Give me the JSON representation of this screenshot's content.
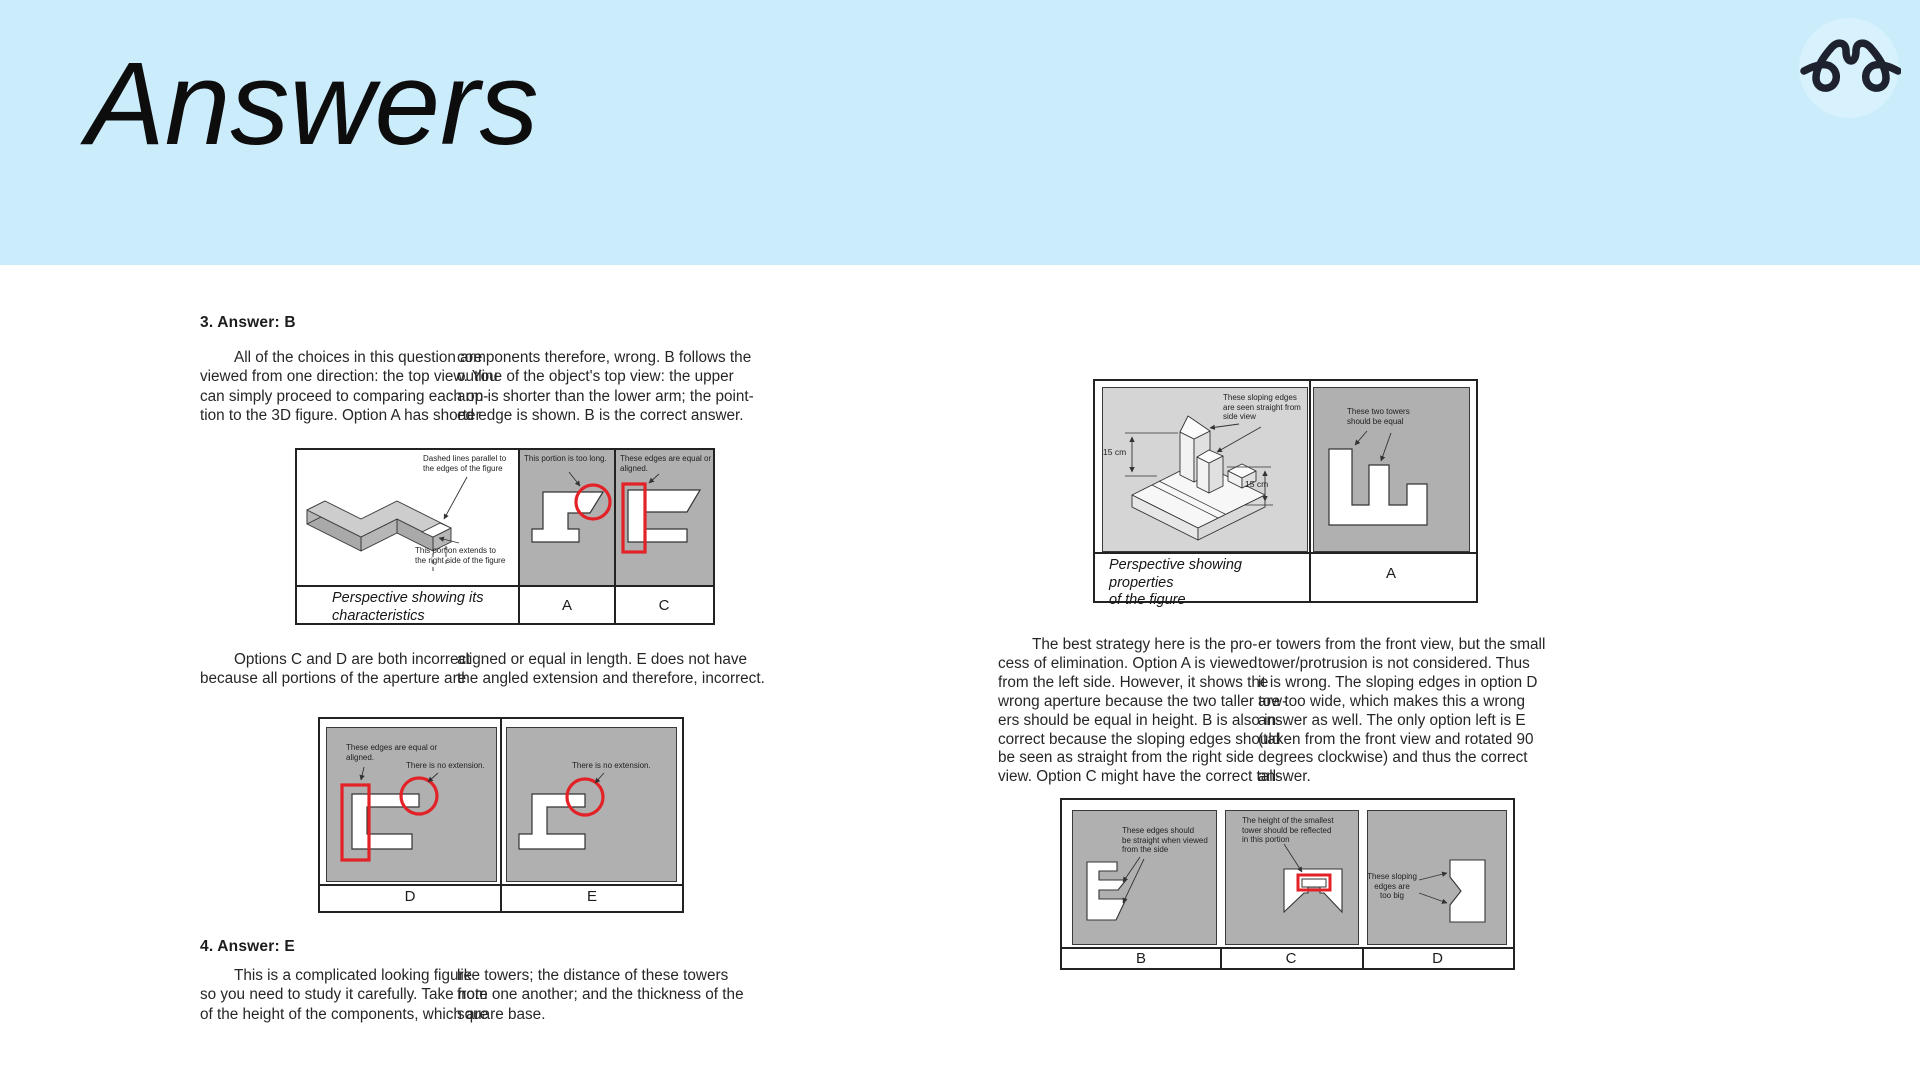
{
  "colors": {
    "header_bg": "#cbecfb",
    "panel_gray": "#b0b0b0",
    "panel_light_gray": "#d5d5d5",
    "highlight_red": "#e32228"
  },
  "header": {
    "title": "Answers"
  },
  "q3": {
    "heading": "3.  Answer: B",
    "p1a": [
      "All of the choices in this question are",
      "viewed from one direction: the top view. You",
      "can simply proceed to comparing each op-",
      "tion to the 3D figure. Option A has shorter"
    ],
    "p1b": [
      "components therefore, wrong. B follows the",
      "outline of the object's top view: the upper",
      "arm is shorter than the lower arm; the point-",
      "ed edge is shown.  B is the correct answer."
    ],
    "p2a": [
      "Options C and D are both incorrect",
      "because all portions of the aperture are"
    ],
    "p2b": [
      "aligned or equal in length. E does not have",
      "the angled extension and therefore, incorrect."
    ]
  },
  "fig1": {
    "ann_dashed": [
      "Dashed lines parallel to",
      "the edges of the figure"
    ],
    "ann_extends": [
      "This portion extends to",
      "the right side of the figure"
    ],
    "ann_toolong": "This portion is too long.",
    "ann_equal": [
      "These edges are equal or",
      "aligned."
    ],
    "caption": [
      "Perspective showing its",
      "characteristics"
    ],
    "label_a": "A",
    "label_c": "C"
  },
  "fig2": {
    "ann_equal": [
      "These edges are equal or",
      "aligned."
    ],
    "ann_noext_d": "There is no extension.",
    "ann_noext_e": "There is no extension.",
    "label_d": "D",
    "label_e": "E"
  },
  "q4": {
    "heading": "4. Answer: E",
    "p1a": [
      "This is a complicated looking figure",
      "so you need to study it carefully. Take note",
      "of the height of the components, which are"
    ],
    "p1b": [
      "like towers; the distance of these towers",
      "from one another; and the thickness of the",
      "square base."
    ]
  },
  "fig3": {
    "ann_sloping": [
      "These sloping edges",
      "are seen straight from",
      "side view"
    ],
    "dim_left": "15 cm",
    "dim_right": "15 cm",
    "ann_towers": [
      "These two towers",
      "should be equal"
    ],
    "caption": [
      "Perspective showing properties",
      "of the figure"
    ],
    "label_a": "A"
  },
  "q4_continued": {
    "p1a": [
      "The best strategy here is the pro-",
      "cess of elimination. Option A is viewed",
      "from the left side. However, it shows the",
      "wrong aperture because the two taller tow-",
      "ers should be equal in height. B is also in-",
      "correct because the sloping edges should",
      "be seen as straight from the right side",
      "view. Option C might have the correct tall-"
    ],
    "p1b": [
      "er towers from the front view, but the small",
      "tower/protrusion is not considered. Thus",
      "it is wrong. The sloping edges in option D",
      "are too wide, which makes this a wrong",
      "answer as well. The only option left is E",
      "(taken from the front view and rotated 90",
      "degrees clockwise) and thus the correct",
      "answer."
    ]
  },
  "fig4": {
    "ann_b": [
      "These edges should",
      "be straight when viewed",
      "from the side"
    ],
    "ann_c": [
      "The height of the smallest",
      "tower should be reflected",
      "in this portion"
    ],
    "ann_d": [
      "These sloping",
      "edges are",
      "too big"
    ],
    "label_b": "B",
    "label_c": "C",
    "label_d": "D"
  }
}
